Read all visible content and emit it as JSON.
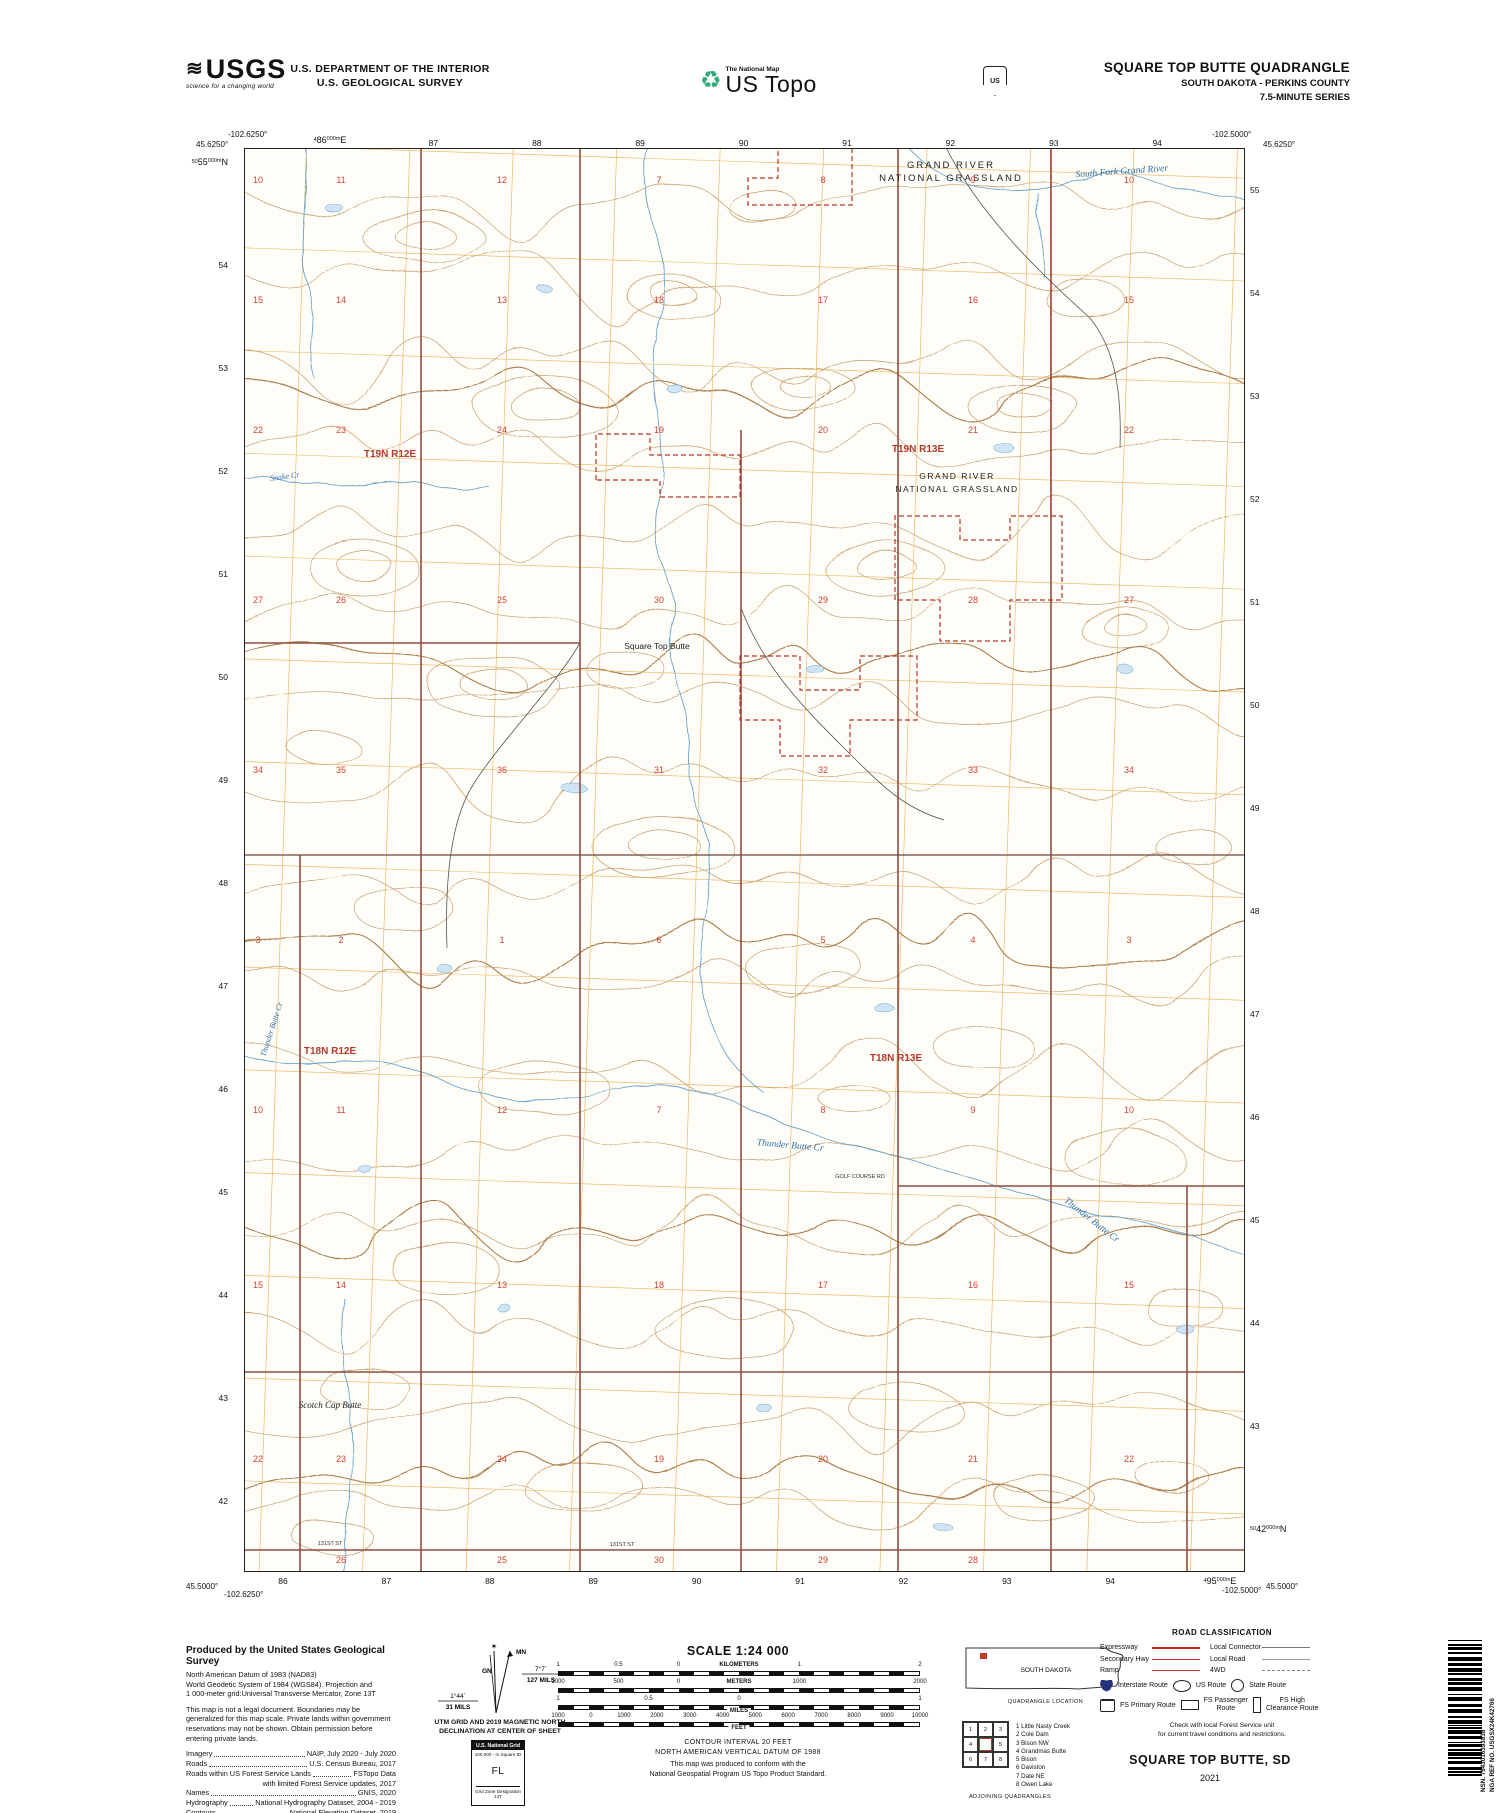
{
  "colors": {
    "section_red": "#cf4338",
    "township_red": "#b5382c",
    "grid_orange": "#e4a43e",
    "contour_tan": "#c79e70",
    "contour_index": "#a87c4e",
    "water_blue": "#6aa4cc",
    "water_label_blue": "#2f6ea6",
    "road_maroon": "#8f4e42",
    "boundary_red": "#b5382c",
    "legend_red": "#c0392b",
    "interstate_blue": "#26327d"
  },
  "header": {
    "usgs_logo": "USGS",
    "usgs_tagline": "science for a changing world",
    "agency_line1": "U.S. DEPARTMENT OF THE INTERIOR",
    "agency_line2": "U.S. GEOLOGICAL SURVEY",
    "program_small": "The National Map",
    "program_large": "US Topo",
    "fs_shield_text": "US",
    "title": "SQUARE TOP BUTTE QUADRANGLE",
    "subtitle": "SOUTH DAKOTA - PERKINS COUNTY",
    "series": "7.5-MINUTE SERIES"
  },
  "map": {
    "corner_coords": {
      "top_left_lon": "-102.6250°",
      "top_left_lat": "45.6250°",
      "top_right_lon": "-102.5000°",
      "top_right_lat": "45.6250°",
      "bottom_left_lat": "45.5000°",
      "bottom_left_lon": "-102.6250°",
      "bottom_right_lon": "-102.5000°",
      "bottom_right_lat": "45.5000°"
    },
    "grid": {
      "top_first": {
        "prefix": "4",
        "value": "86",
        "sup": "000m",
        "suffix": "E"
      },
      "top_rest": [
        "87",
        "88",
        "89",
        "90",
        "91",
        "92",
        "93",
        "94"
      ],
      "bottom_rest": [
        "86",
        "87",
        "88",
        "89",
        "90",
        "91",
        "92",
        "93",
        "94"
      ],
      "bottom_last": {
        "prefix": "4",
        "value": "95",
        "sup": "000m",
        "suffix": "E"
      },
      "left_first": {
        "prefix": "50",
        "value": "55",
        "sup": "000m",
        "suffix": "N"
      },
      "left_rest": [
        "54",
        "53",
        "52",
        "51",
        "50",
        "49",
        "48",
        "47",
        "46",
        "45",
        "44",
        "43",
        "42"
      ],
      "right_rest": [
        "55",
        "54",
        "53",
        "52",
        "51",
        "50",
        "49",
        "48",
        "47",
        "46",
        "45",
        "44",
        "43"
      ],
      "right_last": {
        "prefix": "50",
        "value": "42",
        "sup": "000m",
        "suffix": "N"
      }
    },
    "sections": {
      "rows": [
        [
          "10",
          "11",
          "12",
          "7",
          "8",
          "9",
          "10"
        ],
        [
          "15",
          "14",
          "13",
          "18",
          "17",
          "16",
          "15"
        ],
        [
          "22",
          "23",
          "24",
          "19",
          "20",
          "21",
          "22"
        ],
        [
          "27",
          "26",
          "25",
          "30",
          "29",
          "28",
          "27"
        ],
        [
          "34",
          "35",
          "36",
          "31",
          "32",
          "33",
          "34"
        ],
        [
          "3",
          "2",
          "1",
          "6",
          "5",
          "4",
          "3"
        ],
        [
          "10",
          "11",
          "12",
          "7",
          "8",
          "9",
          "10"
        ],
        [
          "15",
          "14",
          "13",
          "18",
          "17",
          "16",
          "15"
        ],
        [
          "22",
          "23",
          "24",
          "19",
          "20",
          "21",
          "22"
        ],
        [
          "",
          "26",
          "25",
          "30",
          "29",
          "28",
          ""
        ]
      ]
    },
    "labels": {
      "grassland_top1": "GRAND RIVER",
      "grassland_top2": "NATIONAL GRASSLAND",
      "t19n_r12e": "T19N R12E",
      "t19n_r13e": "T19N R13E",
      "grassland_mid1": "GRAND RIVER",
      "grassland_mid2": "NATIONAL GRASSLAND",
      "t18n_r12e": "T18N R12E",
      "t18n_r13e": "T18N R13E",
      "square_top_butte": "Square Top Butte",
      "scotch_cap_butte": "Scotch Cap Butte",
      "golf_course_rd": "GOLF COURSE RD",
      "street_131_a": "131ST ST",
      "street_131_b": "131ST ST",
      "south_fork_grand_river": "South Fork Grand River",
      "snake_cr": "Snake Cr",
      "thunder_butte_cr_1": "Thunder Butte Cr",
      "thunder_butte_cr_2": "Thunder Butte Cr",
      "thunder_butte_cr_3": "Thunder Butte Cr"
    }
  },
  "footer": {
    "produced_by": "Produced by the United States Geological Survey",
    "datum_lines": [
      "North American Datum of 1983 (NAD83)",
      "World Geodetic System of 1984 (WGS84).  Projection and",
      "1 000-meter grid:Universal Transverse Mercator, Zone 13T"
    ],
    "legal_lines": [
      "This map is not a legal document. Boundaries may be",
      "generalized for this map scale. Private lands within government",
      "reservations may not be shown. Obtain permission before",
      "entering private lands."
    ],
    "sources": [
      {
        "label": "Imagery",
        "value": "NAIP, July 2020 - July 2020"
      },
      {
        "label": "Roads",
        "value": "U.S. Census Bureau, 2017"
      },
      {
        "label": "Roads within US Forest Service Lands",
        "value": "FSTopo Data"
      },
      {
        "label": "",
        "value": "with limited Forest Service updates, 2017"
      },
      {
        "label": "Names",
        "value": "GNIS, 2020"
      },
      {
        "label": "Hydrography",
        "value": "National Hydrography Dataset, 2004 - 2019"
      },
      {
        "label": "Contours",
        "value": "National Elevation Dataset, 2019"
      },
      {
        "label": "Boundaries",
        "value": "Multiple sources; see metadata file 2017 - 2021"
      },
      {
        "label": "Public Land Survey System",
        "value": "BLM, 2017"
      },
      {
        "label": "Wetlands",
        "value": "FWS National Wetlands Inventory Not Available"
      }
    ],
    "declination": {
      "mn_label": "MN",
      "gn_label": "GN",
      "mn_deg": "7°7´",
      "mn_mils": "127 MILS",
      "gn_deg": "1°44´",
      "gn_mils": "31 MILS",
      "caption1": "UTM GRID AND 2019 MAGNETIC NORTH",
      "caption2": "DECLINATION AT CENTER OF SHEET"
    },
    "usng": {
      "title": "U.S. National Grid",
      "square_id_label": "100,000 - m Square ID",
      "square_id": "FL",
      "zone_label": "Grid Zone Designation",
      "zone": "13T"
    },
    "scale": {
      "title": "SCALE 1:24 000",
      "bars": [
        {
          "unit": "KILOMETERS",
          "pos": "above",
          "ticks": [
            {
              "t": "1",
              "p": 0
            },
            {
              "t": "0.5",
              "p": 0.167
            },
            {
              "t": "0",
              "p": 0.333
            },
            {
              "t": "1",
              "p": 0.667
            },
            {
              "t": "2",
              "p": 1
            }
          ]
        },
        {
          "unit": "METERS",
          "pos": "above",
          "ticks": [
            {
              "t": "1000",
              "p": 0
            },
            {
              "t": "500",
              "p": 0.167
            },
            {
              "t": "0",
              "p": 0.333
            },
            {
              "t": "1000",
              "p": 0.667
            },
            {
              "t": "2000",
              "p": 1
            }
          ]
        },
        {
          "unit": "MILES",
          "pos": "below",
          "ticks": [
            {
              "t": "1",
              "p": 0
            },
            {
              "t": "0.5",
              "p": 0.25
            },
            {
              "t": "0",
              "p": 0.5
            },
            {
              "t": "1",
              "p": 1
            }
          ]
        },
        {
          "unit": "FEET",
          "pos": "below",
          "ticks": [
            {
              "t": "1000",
              "p": 0
            },
            {
              "t": "0",
              "p": 0.091
            },
            {
              "t": "1000",
              "p": 0.182
            },
            {
              "t": "2000",
              "p": 0.273
            },
            {
              "t": "3000",
              "p": 0.364
            },
            {
              "t": "4000",
              "p": 0.455
            },
            {
              "t": "5000",
              "p": 0.545
            },
            {
              "t": "6000",
              "p": 0.636
            },
            {
              "t": "7000",
              "p": 0.727
            },
            {
              "t": "8000",
              "p": 0.818
            },
            {
              "t": "9000",
              "p": 0.909
            },
            {
              "t": "10000",
              "p": 1
            }
          ]
        }
      ]
    },
    "contour_caption": [
      "CONTOUR INTERVAL 20 FEET",
      "NORTH AMERICAN VERTICAL DATUM OF 1988"
    ],
    "conform_caption": [
      "This map was produced to conform with the",
      "National Geospatial Program US Topo Product Standard."
    ],
    "quad_location": {
      "state": "SOUTH DAKOTA",
      "caption": "QUADRANGLE LOCATION"
    },
    "adjoining": {
      "cells": [
        "1",
        "2",
        "3",
        "4",
        "",
        "5",
        "6",
        "7",
        "8"
      ],
      "list": [
        "1 Little Nasty Creek",
        "2 Cole Dam",
        "3 Bison NW",
        "4 Grandmas Butte",
        "5 Bison",
        "6 Daviston",
        "7 Date NE",
        "8 Owen Lake"
      ],
      "caption": "ADJOINING QUADRANGLES"
    },
    "road_class": {
      "header": "ROAD CLASSIFICATION",
      "left_lines": [
        "Expressway",
        "Secondary Hwy",
        "Ramp"
      ],
      "right_lines": [
        "Local Connector",
        "Local Road",
        "4WD"
      ],
      "shields": [
        "Interstate Route",
        "US Route",
        "State Route"
      ],
      "fs_routes": [
        "FS Primary Route",
        "FS Passenger",
        "Route",
        "FS High",
        "Clearance Route"
      ],
      "note1": "Check with local Forest Service unit",
      "note2": "for current travel conditions and restrictions."
    },
    "sheet_title": "SQUARE TOP BUTTE,  SD",
    "sheet_year": "2021",
    "barcode": {
      "nsn": "NSN.  7643016393838",
      "nga": "NGA REF NO. USGSX24K42766"
    }
  }
}
